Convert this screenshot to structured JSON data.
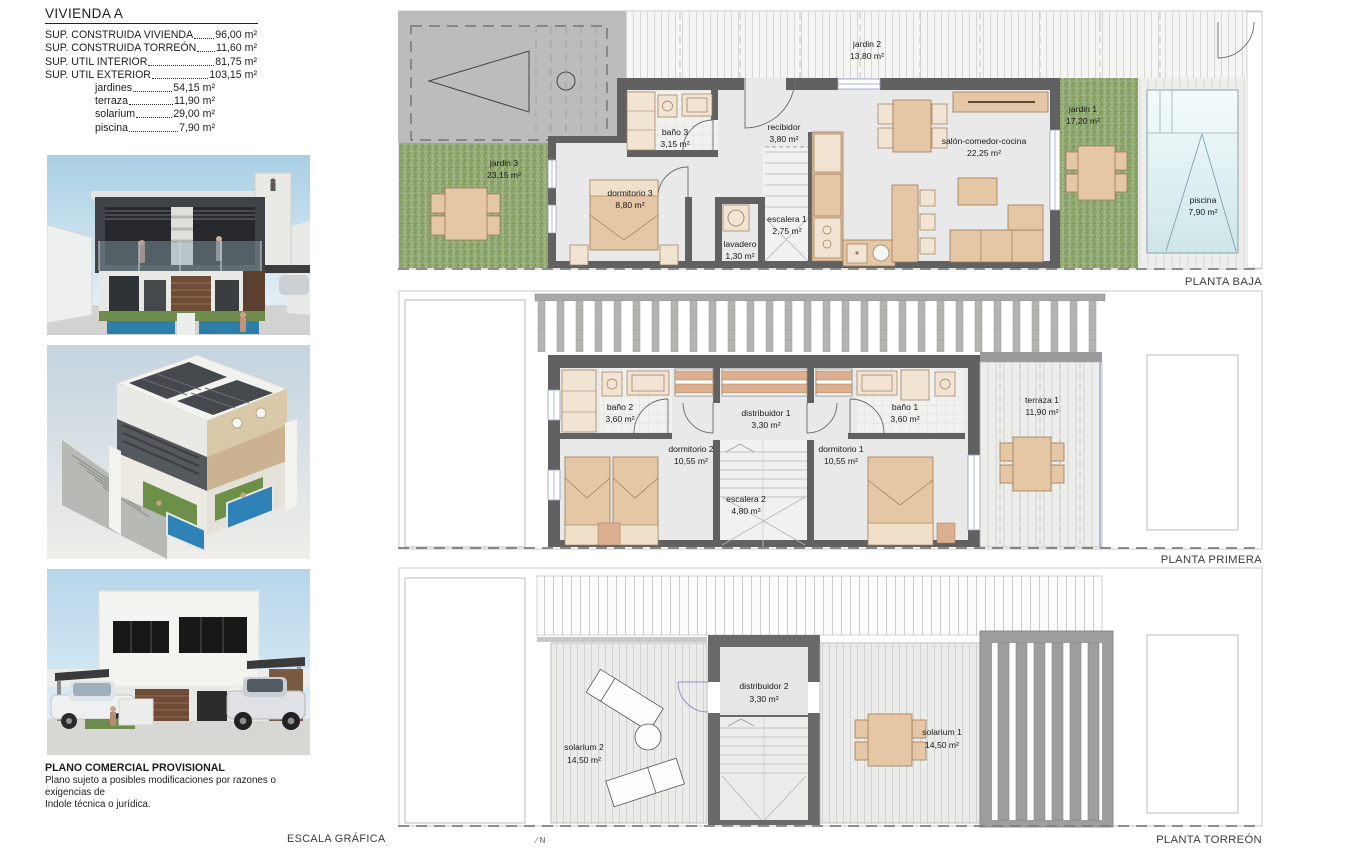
{
  "document": {
    "title": "VIVIENDA A",
    "surfaces": [
      {
        "label": "SUP. CONSTRUIDA VIVIENDA",
        "value": "96,00 m²"
      },
      {
        "label": "SUP. CONSTRUIDA TORREÓN",
        "value": "11,60 m²"
      },
      {
        "label": "SUP. UTIL INTERIOR",
        "value": "81,75 m²"
      },
      {
        "label": "SUP. UTIL EXTERIOR",
        "value": "103,15 m²"
      }
    ],
    "exterior_breakdown": [
      {
        "label": "jardines",
        "value": "54,15 m²"
      },
      {
        "label": "terraza",
        "value": "11,90 m²"
      },
      {
        "label": "solarium",
        "value": "29,00 m²"
      },
      {
        "label": "piscina",
        "value": "7,90 m²"
      }
    ],
    "disclaimer_title": "PLANO COMERCIAL PROVISIONAL",
    "disclaimer_line1": "Plano sujeto a posibles modificaciones por razones o exigencias de",
    "disclaimer_line2": "Indole técnica o jurídica.",
    "scale_label": "ESCALA GRÁFICA",
    "north_label": "N"
  },
  "plans": {
    "baja": {
      "label": "PLANTA BAJA",
      "rooms": [
        {
          "name": "jardin 2",
          "area": "13,80 m²"
        },
        {
          "name": "jardin 3",
          "area": "23,15 m²"
        },
        {
          "name": "baño 3",
          "area": "3,15 m²"
        },
        {
          "name": "recibidor",
          "area": "3,80 m²"
        },
        {
          "name": "dormitorio 3",
          "area": "8,80 m²"
        },
        {
          "name": "lavadero",
          "area": "1,30 m²"
        },
        {
          "name": "escalera 1",
          "area": "2,75 m²"
        },
        {
          "name": "salón-comedor-cocina",
          "area": "22,25 m²"
        },
        {
          "name": "jardin 1",
          "area": "17,20 m²"
        },
        {
          "name": "piscina",
          "area": "7,90 m²"
        }
      ]
    },
    "primera": {
      "label": "PLANTA PRIMERA",
      "rooms": [
        {
          "name": "baño 2",
          "area": "3,60 m²"
        },
        {
          "name": "dormitorio 2",
          "area": "10,55 m²"
        },
        {
          "name": "distribuidor 1",
          "area": "3,30 m²"
        },
        {
          "name": "escalera 2",
          "area": "4,80 m²"
        },
        {
          "name": "baño 1",
          "area": "3,60 m²"
        },
        {
          "name": "dormitorio 1",
          "area": "10,55 m²"
        },
        {
          "name": "terraza 1",
          "area": "11,90 m²"
        }
      ]
    },
    "torreon": {
      "label": "PLANTA TORREÓN",
      "rooms": [
        {
          "name": "solarium 2",
          "area": "14,50 m²"
        },
        {
          "name": "distribuidor 2",
          "area": "3,30 m²"
        },
        {
          "name": "solarium 1",
          "area": "14,50 m²"
        }
      ]
    }
  },
  "colors": {
    "wall_gray": "#616161",
    "floor_gray": "#e9e9e9",
    "garden_green": "#92a873",
    "furniture_tan": "#e6c7a5",
    "pool_blue": "#cde6e9",
    "door_blue": "#9191c9",
    "sky_blue": "#aed2e6"
  }
}
